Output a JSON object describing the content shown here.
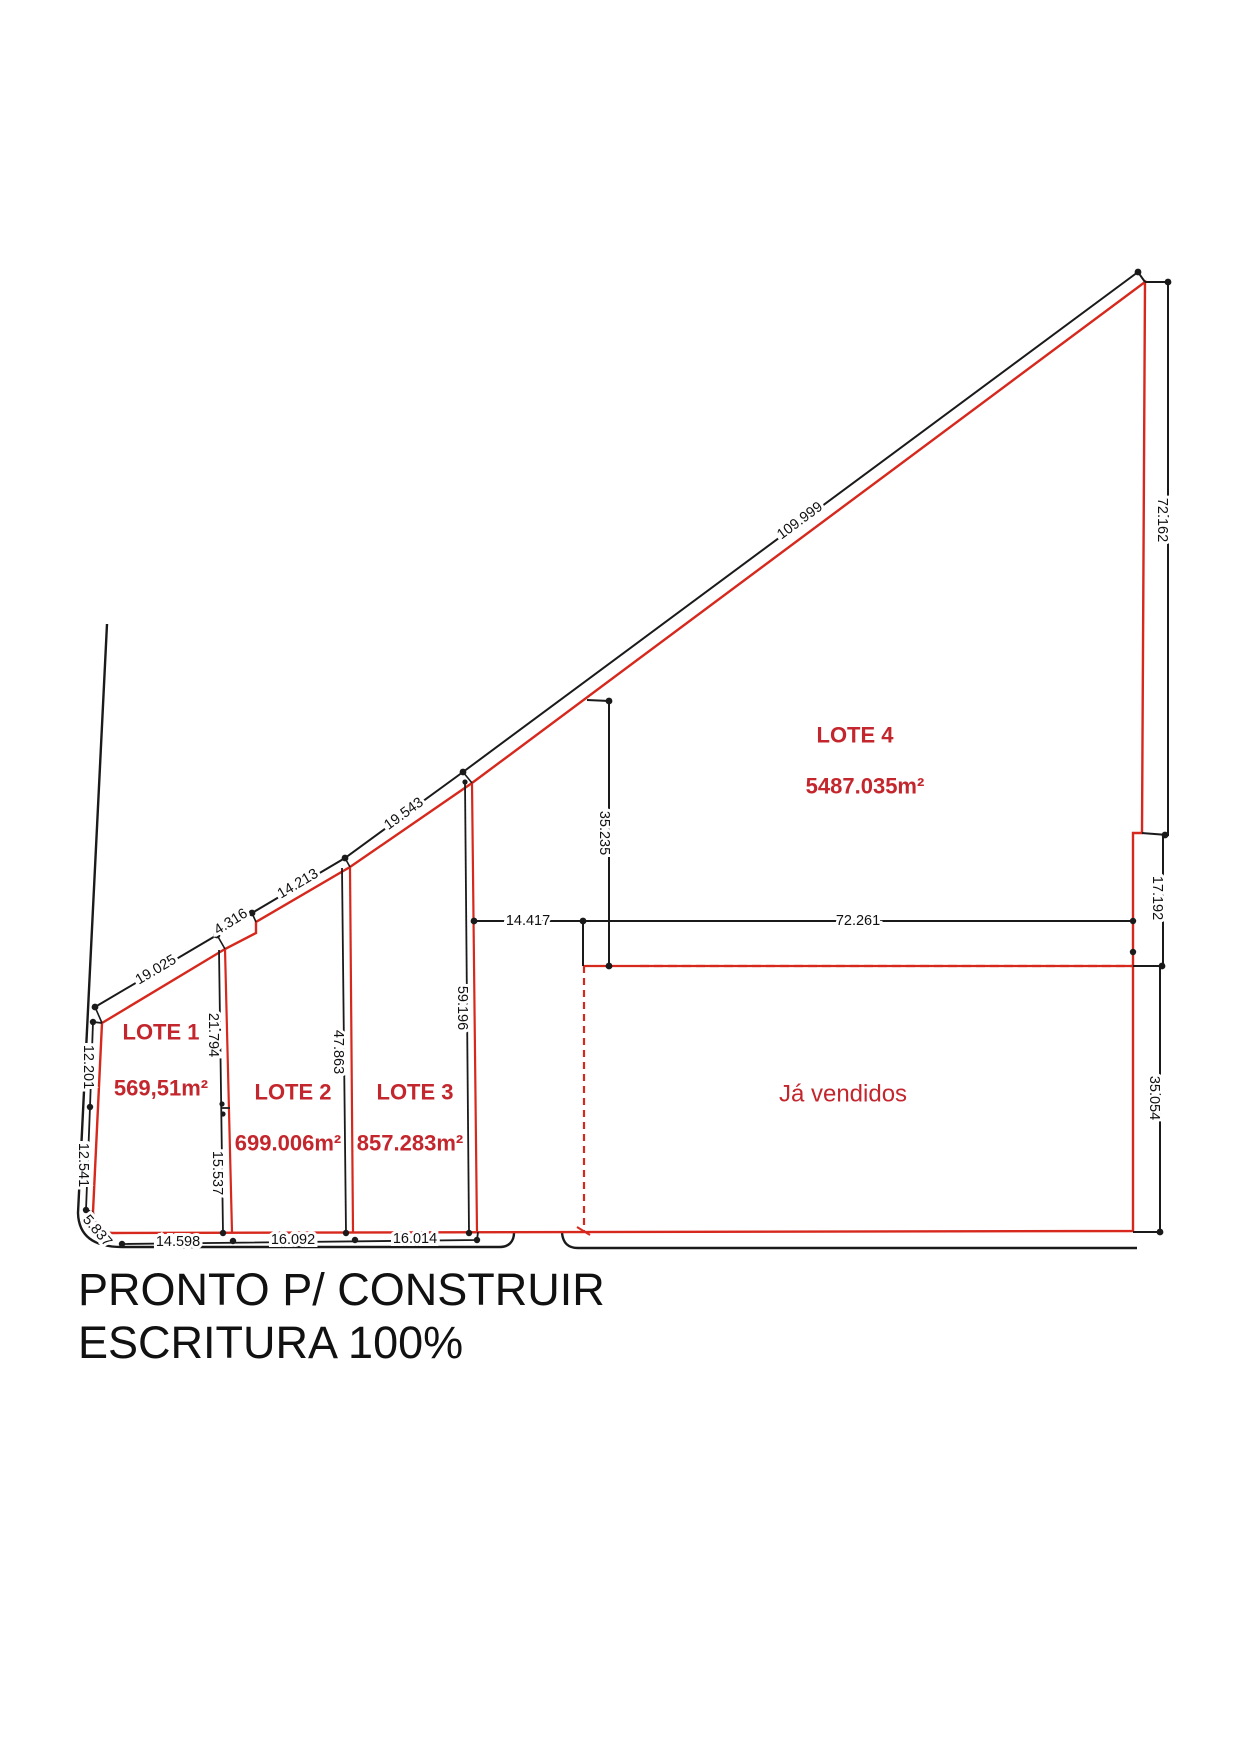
{
  "drawing": {
    "lots": [
      {
        "name": "LOTE 1",
        "area": "569,51m²"
      },
      {
        "name": "LOTE 2",
        "area": "699.006m²"
      },
      {
        "name": "LOTE 3",
        "area": "857.283m²"
      },
      {
        "name": "LOTE 4",
        "area": "5487.035m²"
      }
    ],
    "sold_area_label": "Já vendidos",
    "dimensions": {
      "street_front": [
        "19.025",
        "4.316",
        "14.213",
        "19.543",
        "109.999"
      ],
      "right_side": [
        "72.162",
        "17.192",
        "35.054"
      ],
      "left_side": [
        "12.201",
        "12.541"
      ],
      "corner_arc": "5.837",
      "bottom_edge": [
        "14.598",
        "16.092",
        "16.014"
      ],
      "inner_line": [
        "14.417",
        "72.261"
      ],
      "lot4_left": "35.235",
      "divider_1_2": [
        "21.794",
        "15.537"
      ],
      "divider_2_3": "47.863",
      "divider_3_4": "59.196"
    }
  },
  "footer": {
    "line1": "PRONTO P/ CONSTRUIR",
    "line2": "ESCRITURA 100%"
  },
  "colors": {
    "boundary_red": "#d6281c",
    "label_red": "#c3262c",
    "line_black": "#1a1a1a",
    "background": "#ffffff"
  }
}
